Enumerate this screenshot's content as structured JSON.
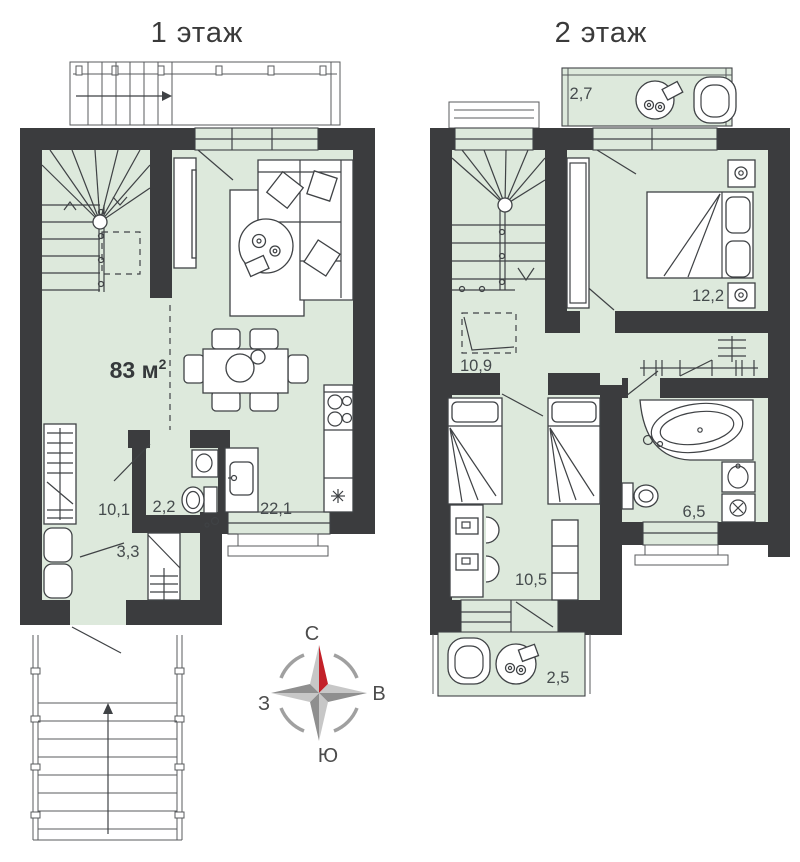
{
  "page": {
    "title_floor1": "1 этаж",
    "title_floor2": "2 этаж"
  },
  "floor1": {
    "total_area": "83 м",
    "total_area_sup": "2",
    "rooms": [
      {
        "name": "hallway",
        "area": "10,1"
      },
      {
        "name": "wc",
        "area": "2,2"
      },
      {
        "name": "storage",
        "area": "3,3"
      },
      {
        "name": "kitchen-living-room",
        "area": "22,1"
      }
    ]
  },
  "floor2": {
    "rooms": [
      {
        "name": "balcony-top",
        "area": "2,7"
      },
      {
        "name": "bedroom",
        "area": "12,2"
      },
      {
        "name": "hall",
        "area": "10,9"
      },
      {
        "name": "kids-room",
        "area": "10,5"
      },
      {
        "name": "bathroom",
        "area": "6,5"
      },
      {
        "name": "balcony-bottom",
        "area": "2,5"
      }
    ]
  },
  "compass": {
    "north": "С",
    "east": "В",
    "south": "Ю",
    "west": "З"
  },
  "colors": {
    "wall": "#3b3c3e",
    "room_fill": "#dde9dc",
    "compass_red": "#c32129",
    "compass_gray": "#9b9b9b",
    "text": "#454b4d"
  }
}
